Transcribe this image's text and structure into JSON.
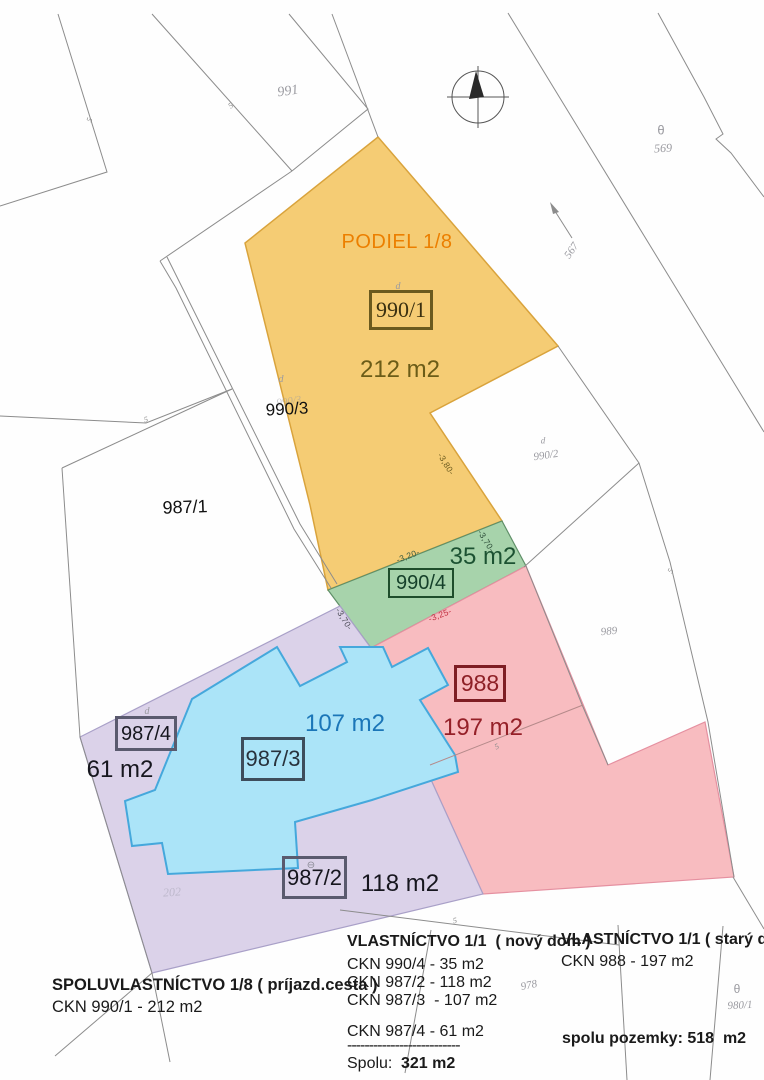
{
  "regions": {
    "podiel": {
      "label": "PODIEL 1/8"
    },
    "p990_1": {
      "id": "990/1",
      "area": "212 m2"
    },
    "p990_4": {
      "id": "990/4",
      "area": "35 m2"
    },
    "p988": {
      "id": "988",
      "area": "197 m2"
    },
    "p987_3": {
      "id": "987/3",
      "area": "107 m2"
    },
    "p987_4": {
      "id": "987/4",
      "area": "61 m2"
    },
    "p987_2": {
      "id": "987/2",
      "area": "118 m2"
    }
  },
  "parcels": {
    "p991": "991",
    "p990_3": "990/3",
    "p987_1": "987/1",
    "p990_2": "990/2",
    "p989": "989",
    "p978": "978",
    "p980_1": "980/1",
    "p569": "569",
    "p567": "567"
  },
  "marks": {
    "d": "d",
    "theta": "θ",
    "circle": "⊖",
    "tick": "5",
    "ghost": "202"
  },
  "dims": {
    "top": "-3,20-",
    "right": "-3,70-",
    "red": "-3,25-",
    "left": "-3,70-",
    "yellow": "-3,80-"
  },
  "legend": {
    "left": {
      "title": "SPOLUVLASTNÍCTVO 1/8 ( príjazd.cesta )",
      "line1": "CKN 990/1 - 212 m2"
    },
    "middle": {
      "title": "VLASTNÍCTVO 1/1  ( nový dom )",
      "lines": [
        "CKN 990/4 - 35 m2",
        "CKN 987/2 - 118 m2",
        "CKN 987/3  - 107 m2",
        "CKN 987/4 - 61 m2"
      ],
      "divider": "--------------------------",
      "total_label": "Spolu:",
      "total_value": "321 m2"
    },
    "right": {
      "title": "VLASTNÍCTVO 1/1 ( starý dom )",
      "line1": "CKN 988 - 197 m2",
      "total": "spolu pozemky: 518  m2"
    }
  },
  "colors": {
    "yellow": "#F5CC74",
    "green": "#A7D3AB",
    "pink": "#F8BCC0",
    "lavender": "#DBD2E9",
    "blue": "#ABE4F8",
    "podiel_text": "#EC7F00",
    "olive_text": "#6B5C18",
    "dark_green_text": "#1C5232",
    "dark_red_text": "#952028",
    "blue_text": "#1B76B8",
    "black_text": "#16161E"
  }
}
